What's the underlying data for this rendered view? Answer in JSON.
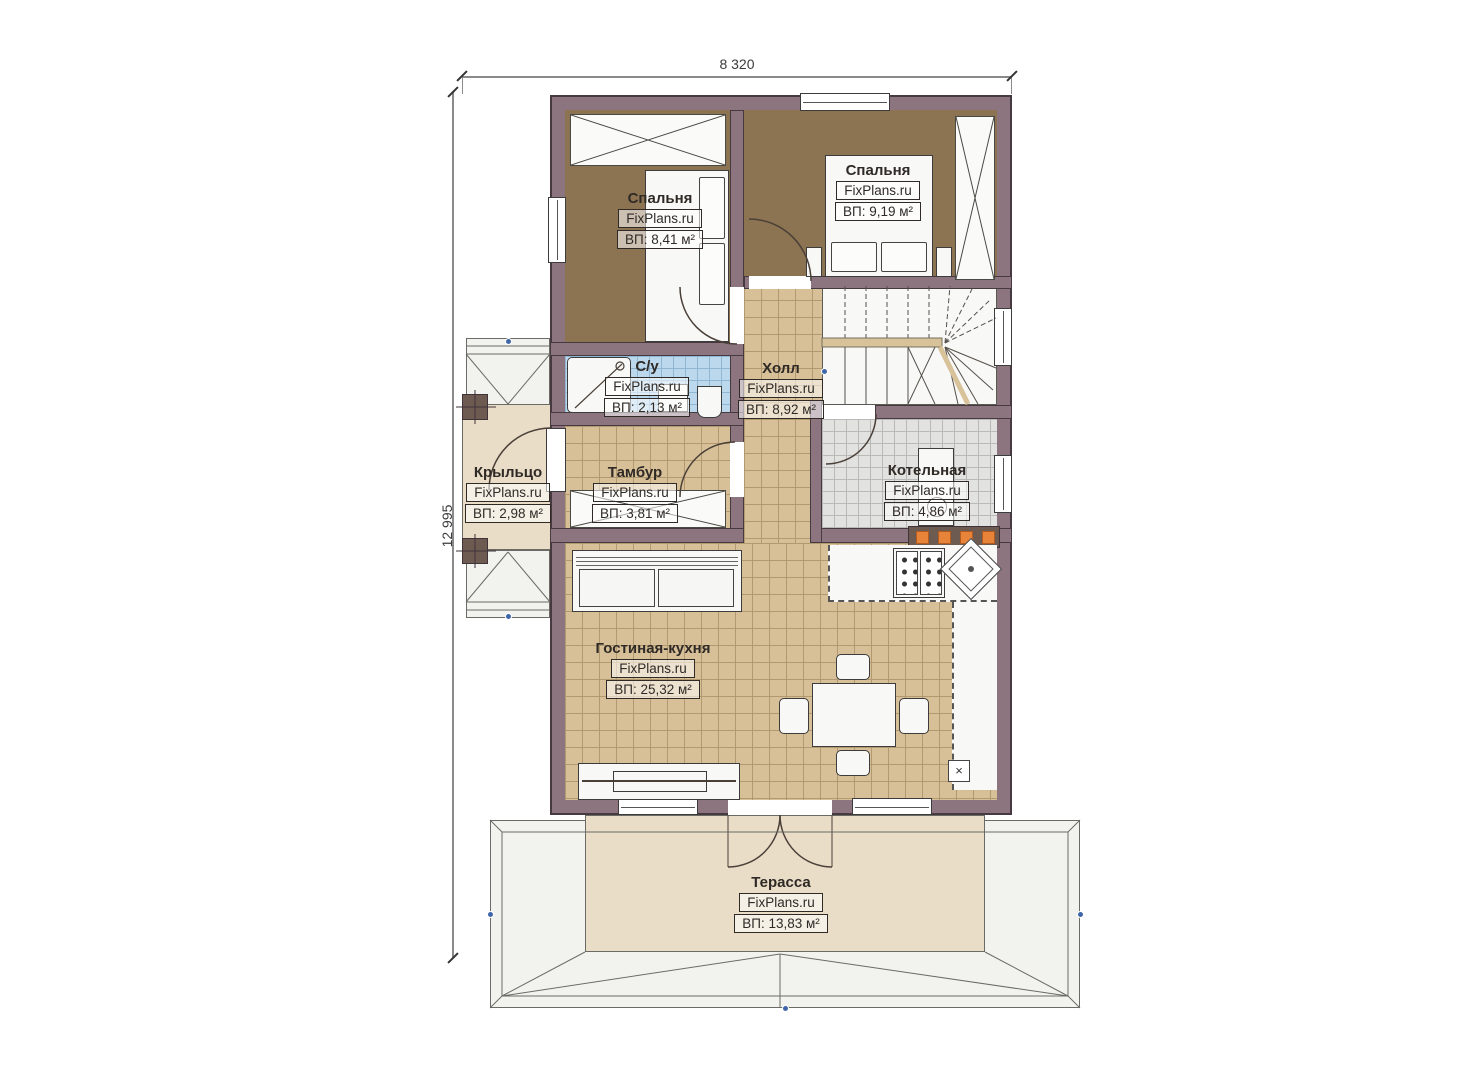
{
  "dimensions": {
    "width": "8 320",
    "height": "12 995"
  },
  "symbols": {
    "vent": "×"
  },
  "rooms": [
    {
      "id": "bedroom-1",
      "name": "Спальня",
      "brand": "FixPlans.ru",
      "area": "ВП: 8,41 м²"
    },
    {
      "id": "bedroom-2",
      "name": "Спальня",
      "brand": "FixPlans.ru",
      "area": "ВП: 9,19 м²"
    },
    {
      "id": "bathroom",
      "name": "С/у",
      "brand": "FixPlans.ru",
      "area": "ВП: 2,13 м²"
    },
    {
      "id": "hall",
      "name": "Холл",
      "brand": "FixPlans.ru",
      "area": "ВП: 8,92 м²"
    },
    {
      "id": "porch",
      "name": "Крыльцо",
      "brand": "FixPlans.ru",
      "area": "ВП: 2,98 м²"
    },
    {
      "id": "tambour",
      "name": "Тамбур",
      "brand": "FixPlans.ru",
      "area": "ВП: 3,81 м²"
    },
    {
      "id": "boiler-room",
      "name": "Котельная",
      "brand": "FixPlans.ru",
      "area": "ВП: 4,86 м²"
    },
    {
      "id": "living-kitchen",
      "name": "Гостиная-кухня",
      "brand": "FixPlans.ru",
      "area": "ВП: 25,32 м²"
    },
    {
      "id": "terrace",
      "name": "Терасса",
      "brand": "FixPlans.ru",
      "area": "ВП: 13,83 м²"
    }
  ],
  "colors": {
    "wall": "#8d7580",
    "wall_line": "#463a40",
    "floor_wood": "#8c7352",
    "floor_tile": "#d7bf97",
    "tile_line": "#b39970",
    "floor_bath": "#bcd8ec",
    "bath_line": "#8fb6d2",
    "floor_boiler": "#e2e2e0",
    "boiler_line": "#b9b9b7",
    "floor_outdoor": "#e9ddc8",
    "roof": "#f2f2ef",
    "accent_orange": "#e8833a",
    "marker_blue": "#3f66a8"
  }
}
